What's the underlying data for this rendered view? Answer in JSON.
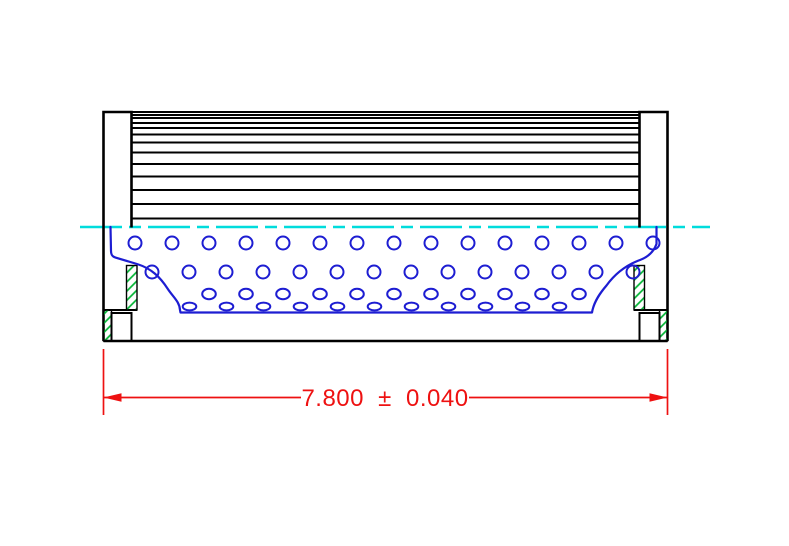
{
  "drawing": {
    "kind": "technical cross-section, side view of cylindrical filter element",
    "views": [
      "pleated media block",
      "left end cap",
      "right end cap",
      "perforated core cutaway",
      "centerline",
      "overall length dimension"
    ]
  },
  "dimension": {
    "label": "7.800 ± 0.040",
    "nominal": "7.800",
    "tolerance": "0.040"
  },
  "colors": {
    "outline_black": "#000000",
    "core_blue": "#1d1dd2",
    "centerline_cyan": "#00dcdc",
    "dimension_red": "#ee1111",
    "hatch_green": "#00b432",
    "background": "#ffffff"
  },
  "geometry": {
    "pleat_line_ys": [
      112,
      115,
      118,
      123,
      128,
      134.5,
      142.5,
      152.5,
      164,
      176.5,
      190,
      204,
      218.5
    ],
    "pleat_x1": 131.5,
    "pleat_x2": 639.5,
    "holes": {
      "pitch_x": 37,
      "rows": [
        {
          "y": 243,
          "x_start": 135,
          "count": 15,
          "rx": 6.5,
          "ry": 6.5
        },
        {
          "y": 272,
          "x_start": 152,
          "count": 14,
          "rx": 6.5,
          "ry": 6.5
        },
        {
          "y": 294,
          "x_start": 209,
          "count": 11,
          "rx": 6.8,
          "ry": 5.2
        },
        {
          "y": 306.5,
          "x_start": 189.5,
          "count": 11,
          "rx": 6.8,
          "ry": 3.9
        }
      ]
    }
  }
}
